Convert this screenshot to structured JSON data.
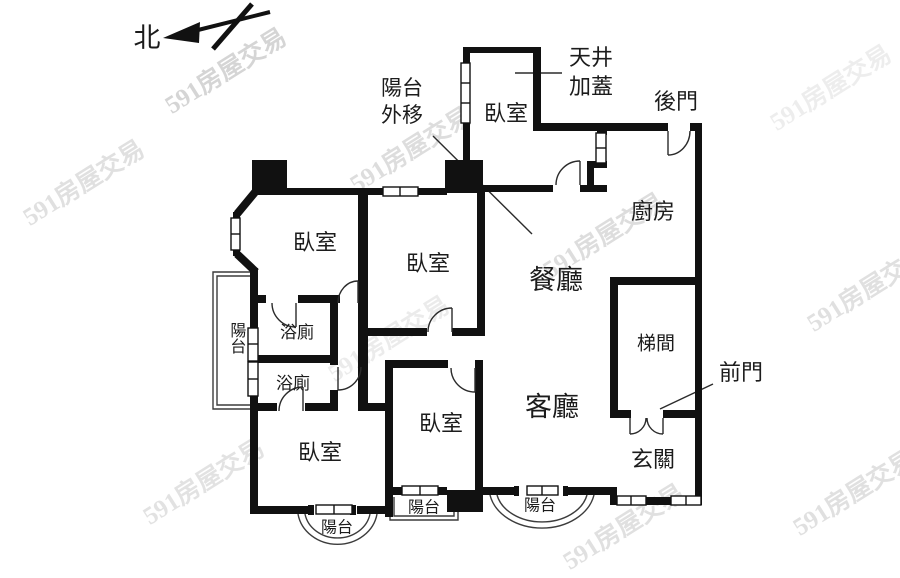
{
  "colors": {
    "background": "#ffffff",
    "wall": "#111111",
    "line": "#2b2b2b",
    "thin": "#3c3c3c",
    "watermark": "#c7c7c7",
    "label": "#1c1c1c"
  },
  "compass": {
    "north_label": "北"
  },
  "watermark": {
    "text": "591房屋交易"
  },
  "annotations": {
    "balcony_moved_line1": "陽台",
    "balcony_moved_line2": "外移",
    "lightwell_line1": "天井",
    "lightwell_line2": "加蓋",
    "back_door": "後門",
    "front_door": "前門"
  },
  "rooms": {
    "bedroom_top": "臥室",
    "kitchen": "廚房",
    "dining": "餐廳",
    "living": "客廳",
    "entrance": "玄關",
    "stairwell": "梯間",
    "bedroom_upper_left": "臥室",
    "bedroom_middle": "臥室",
    "bedroom_lower_left": "臥室",
    "bedroom_lower_middle": "臥室",
    "bath_upper": "浴廁",
    "bath_lower": "浴廁",
    "balcony_left": "陽台",
    "balcony_bottom_left": "陽台",
    "balcony_bottom_middle": "陽台",
    "balcony_bottom_right": "陽台"
  }
}
